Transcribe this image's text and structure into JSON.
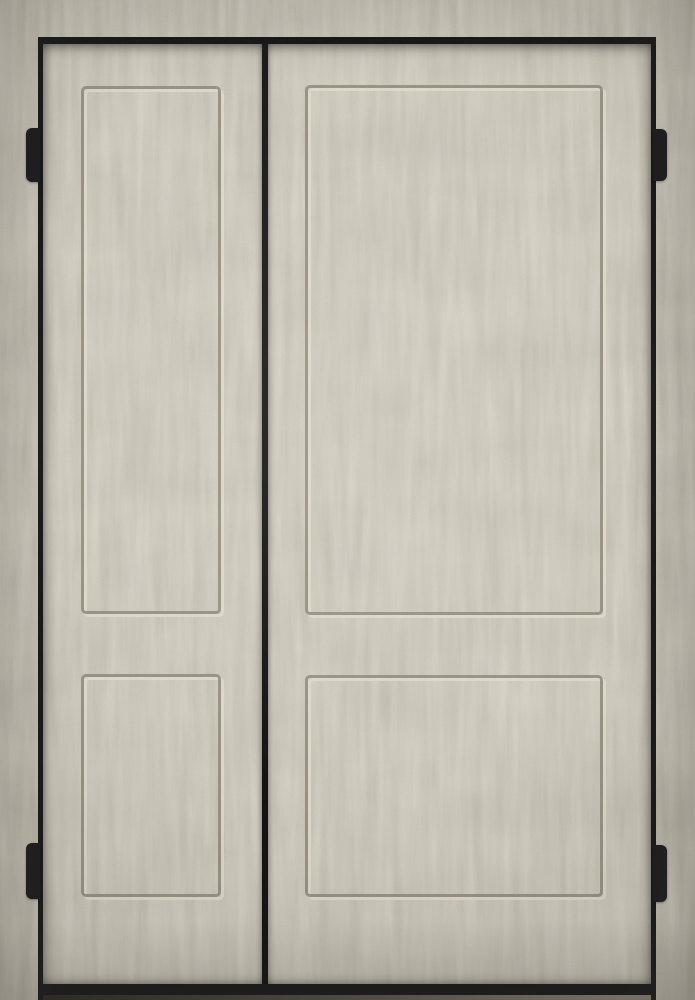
{
  "meta": {
    "description": "Product photo of a double two-panel shaker style door pair in a concrete/plaster beige finish, mounted in a thin black metal frame with four protruding black hinges. No text, controls or labels are visible in the image."
  },
  "colors": {
    "base": "#c6c0b2",
    "wall_shade": "#aba496",
    "blotch": "#6b6657",
    "streak": "#ebe6d4",
    "frame": "#17171a",
    "seam": "#1b1b1d",
    "groove_dark": "#8b8577",
    "groove_light": "#ded9ca",
    "hinge": "#1b1b1e",
    "floor_dark": "#2a2822",
    "floor_light": "#8f897c"
  },
  "elements": {
    "frame": "black rectangular door frame with thicker bottom threshold rail",
    "doors": [
      {
        "name": "left-door-leaf",
        "width_ratio": "narrow",
        "panels": [
          "upper tall recessed panel",
          "lower short recessed panel"
        ]
      },
      {
        "name": "right-door-leaf",
        "width_ratio": "wide",
        "panels": [
          "upper tall recessed panel",
          "lower short recessed panel"
        ]
      }
    ],
    "hinges": [
      "left-top",
      "left-bottom",
      "right-top",
      "right-bottom"
    ],
    "finish": "mottled concrete texture with vertical streaks, fine grain and corner vignette"
  }
}
